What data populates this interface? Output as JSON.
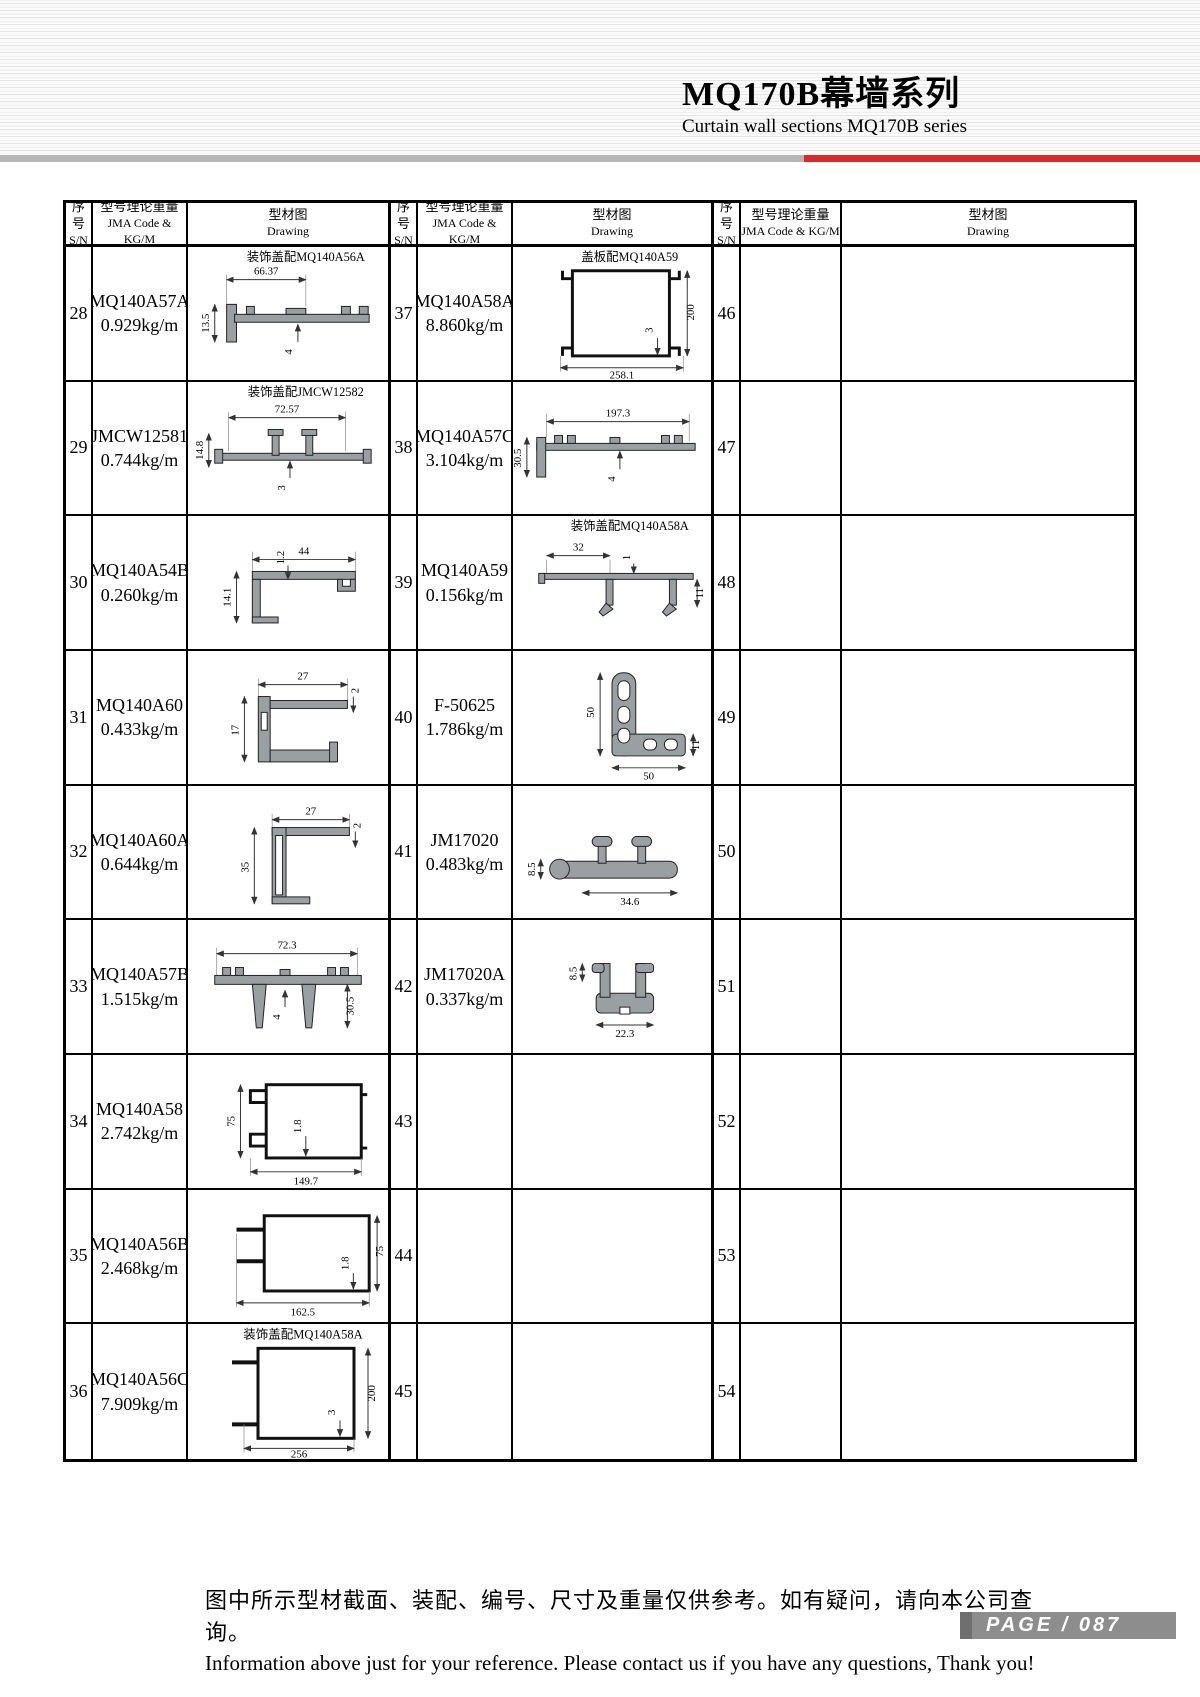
{
  "header": {
    "title_cn": "MQ170B幕墙系列",
    "title_en": "Curtain wall sections MQ170B series"
  },
  "table": {
    "col_headers": {
      "sn_cn": "序号",
      "sn_en": "S/N",
      "code_cn": "型号理论重量",
      "code_en": "JMA Code & KG/M",
      "draw_cn": "型材图",
      "draw_en": "Drawing"
    },
    "rows_a": [
      {
        "sn": "28",
        "code": "MQ140A57A",
        "weight": "0.929kg/m",
        "caption": "装饰盖配MQ140A56A",
        "d1": "66.37",
        "d2": "13.5",
        "d3": "4"
      },
      {
        "sn": "29",
        "code": "JMCW12581",
        "weight": "0.744kg/m",
        "caption": "装饰盖配JMCW12582",
        "d1": "72.57",
        "d2": "14.8",
        "d3": "3"
      },
      {
        "sn": "30",
        "code": "MQ140A54B",
        "weight": "0.260kg/m",
        "d1": "44",
        "d2": "14.1",
        "d3": "1.2"
      },
      {
        "sn": "31",
        "code": "MQ140A60",
        "weight": "0.433kg/m",
        "d1": "27",
        "d2": "17",
        "d3": "2"
      },
      {
        "sn": "32",
        "code": "MQ140A60A",
        "weight": "0.644kg/m",
        "d1": "27",
        "d2": "35",
        "d3": "2"
      },
      {
        "sn": "33",
        "code": "MQ140A57B",
        "weight": "1.515kg/m",
        "d1": "72.3",
        "d2": "4",
        "d3": "30.5"
      },
      {
        "sn": "34",
        "code": "MQ140A58",
        "weight": "2.742kg/m",
        "d1": "75",
        "d2": "1.8",
        "d3": "149.7"
      },
      {
        "sn": "35",
        "code": "MQ140A56B",
        "weight": "2.468kg/m",
        "d1": "162.5",
        "d2": "1.8",
        "d3": "75"
      },
      {
        "sn": "36",
        "code": "MQ140A56C",
        "weight": "7.909kg/m",
        "caption": "装饰盖配MQ140A58A",
        "d1": "256",
        "d2": "3",
        "d3": "200"
      }
    ],
    "rows_b": [
      {
        "sn": "37",
        "code": "MQ140A58A",
        "weight": "8.860kg/m",
        "caption": "盖板配MQ140A59",
        "d1": "258.1",
        "d2": "3",
        "d3": "200"
      },
      {
        "sn": "38",
        "code": "MQ140A57C",
        "weight": "3.104kg/m",
        "d1": "197.3",
        "d2": "30.5",
        "d3": "4"
      },
      {
        "sn": "39",
        "code": "MQ140A59",
        "weight": "0.156kg/m",
        "caption": "装饰盖配MQ140A58A",
        "d1": "32",
        "d2": "1",
        "d3": "11"
      },
      {
        "sn": "40",
        "code": "F-50625",
        "weight": "1.786kg/m",
        "d1": "50",
        "d2": "11",
        "d3": "50"
      },
      {
        "sn": "41",
        "code": "JM17020",
        "weight": "0.483kg/m",
        "d1": "8.5",
        "d2": "34.6"
      },
      {
        "sn": "42",
        "code": "JM17020A",
        "weight": "0.337kg/m",
        "d1": "8.5",
        "d2": "22.3"
      },
      {
        "sn": "43"
      },
      {
        "sn": "44"
      },
      {
        "sn": "45"
      }
    ],
    "rows_c": [
      {
        "sn": "46"
      },
      {
        "sn": "47"
      },
      {
        "sn": "48"
      },
      {
        "sn": "49"
      },
      {
        "sn": "50"
      },
      {
        "sn": "51"
      },
      {
        "sn": "52"
      },
      {
        "sn": "53"
      },
      {
        "sn": "54"
      }
    ]
  },
  "footer": {
    "note_cn": "图中所示型材截面、装配、编号、尺寸及重量仅供参考。如有疑问，请向本公司查询。",
    "note_en": "Information above just for your reference. Please contact us if you have any questions, Thank you!",
    "page_label": "PAGE / 087"
  }
}
